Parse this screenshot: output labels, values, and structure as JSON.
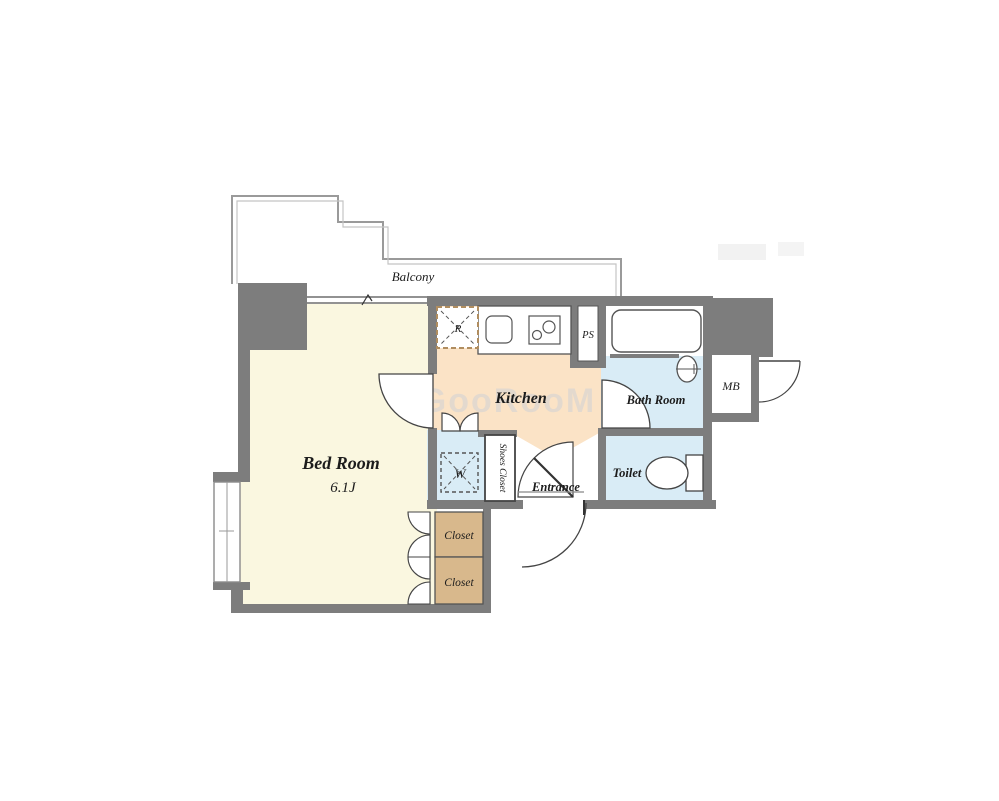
{
  "floor_plan": {
    "watermark": "GooRooM",
    "colors": {
      "wall": "#7d7d7d",
      "bedroom_floor": "#faf7e0",
      "kitchen_floor": "#fbe3c6",
      "wet_area_floor": "#d9ecf6",
      "closet_floor": "#d8b88c",
      "outline": "#4a4a4a",
      "balcony_line": "#9a9a9a"
    },
    "labels": {
      "balcony": "Balcony",
      "bed_room": "Bed Room",
      "bed_room_size": "6.1J",
      "kitchen": "Kitchen",
      "bath_room": "Bath Room",
      "toilet": "Toilet",
      "entrance": "Entrance",
      "shoes_closet": "Shoes Closet",
      "closet_upper": "Closet",
      "closet_lower": "Closet",
      "pipe_space": "PS",
      "meter_box": "MB",
      "refrigerator_space": "R",
      "washer_space": "W"
    }
  }
}
